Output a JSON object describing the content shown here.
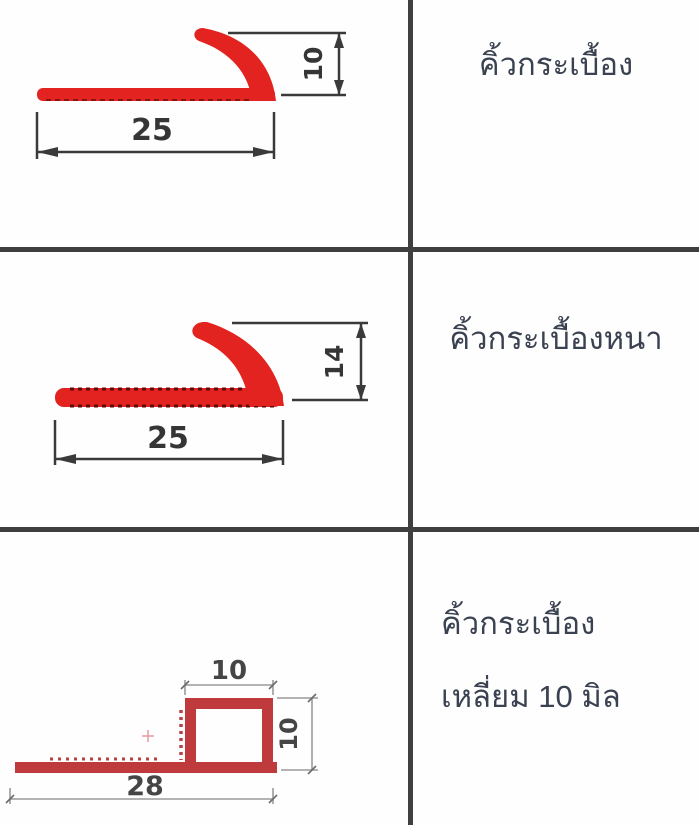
{
  "table": {
    "grid_color": "#3f3f3f",
    "rows": [
      {
        "label": "คิ้วกระเบื้อง",
        "profile_type": "round-edge-tile-trim",
        "profile_color": "#e2231f",
        "dims": {
          "width": "25",
          "height": "10"
        }
      },
      {
        "label": "คิ้วกระเบื้องหนา",
        "profile_type": "thick-round-edge-tile-trim",
        "profile_color": "#e2231f",
        "dims": {
          "width": "25",
          "height": "14"
        }
      },
      {
        "label_line1": "คิ้วกระเบื้อง",
        "label_line2": "เหลี่ยม 10 มิล",
        "profile_type": "square-box-tile-trim",
        "profile_color": "#bf3a3c",
        "dims": {
          "width": "28",
          "height": "10",
          "box_top": "10"
        }
      }
    ]
  }
}
